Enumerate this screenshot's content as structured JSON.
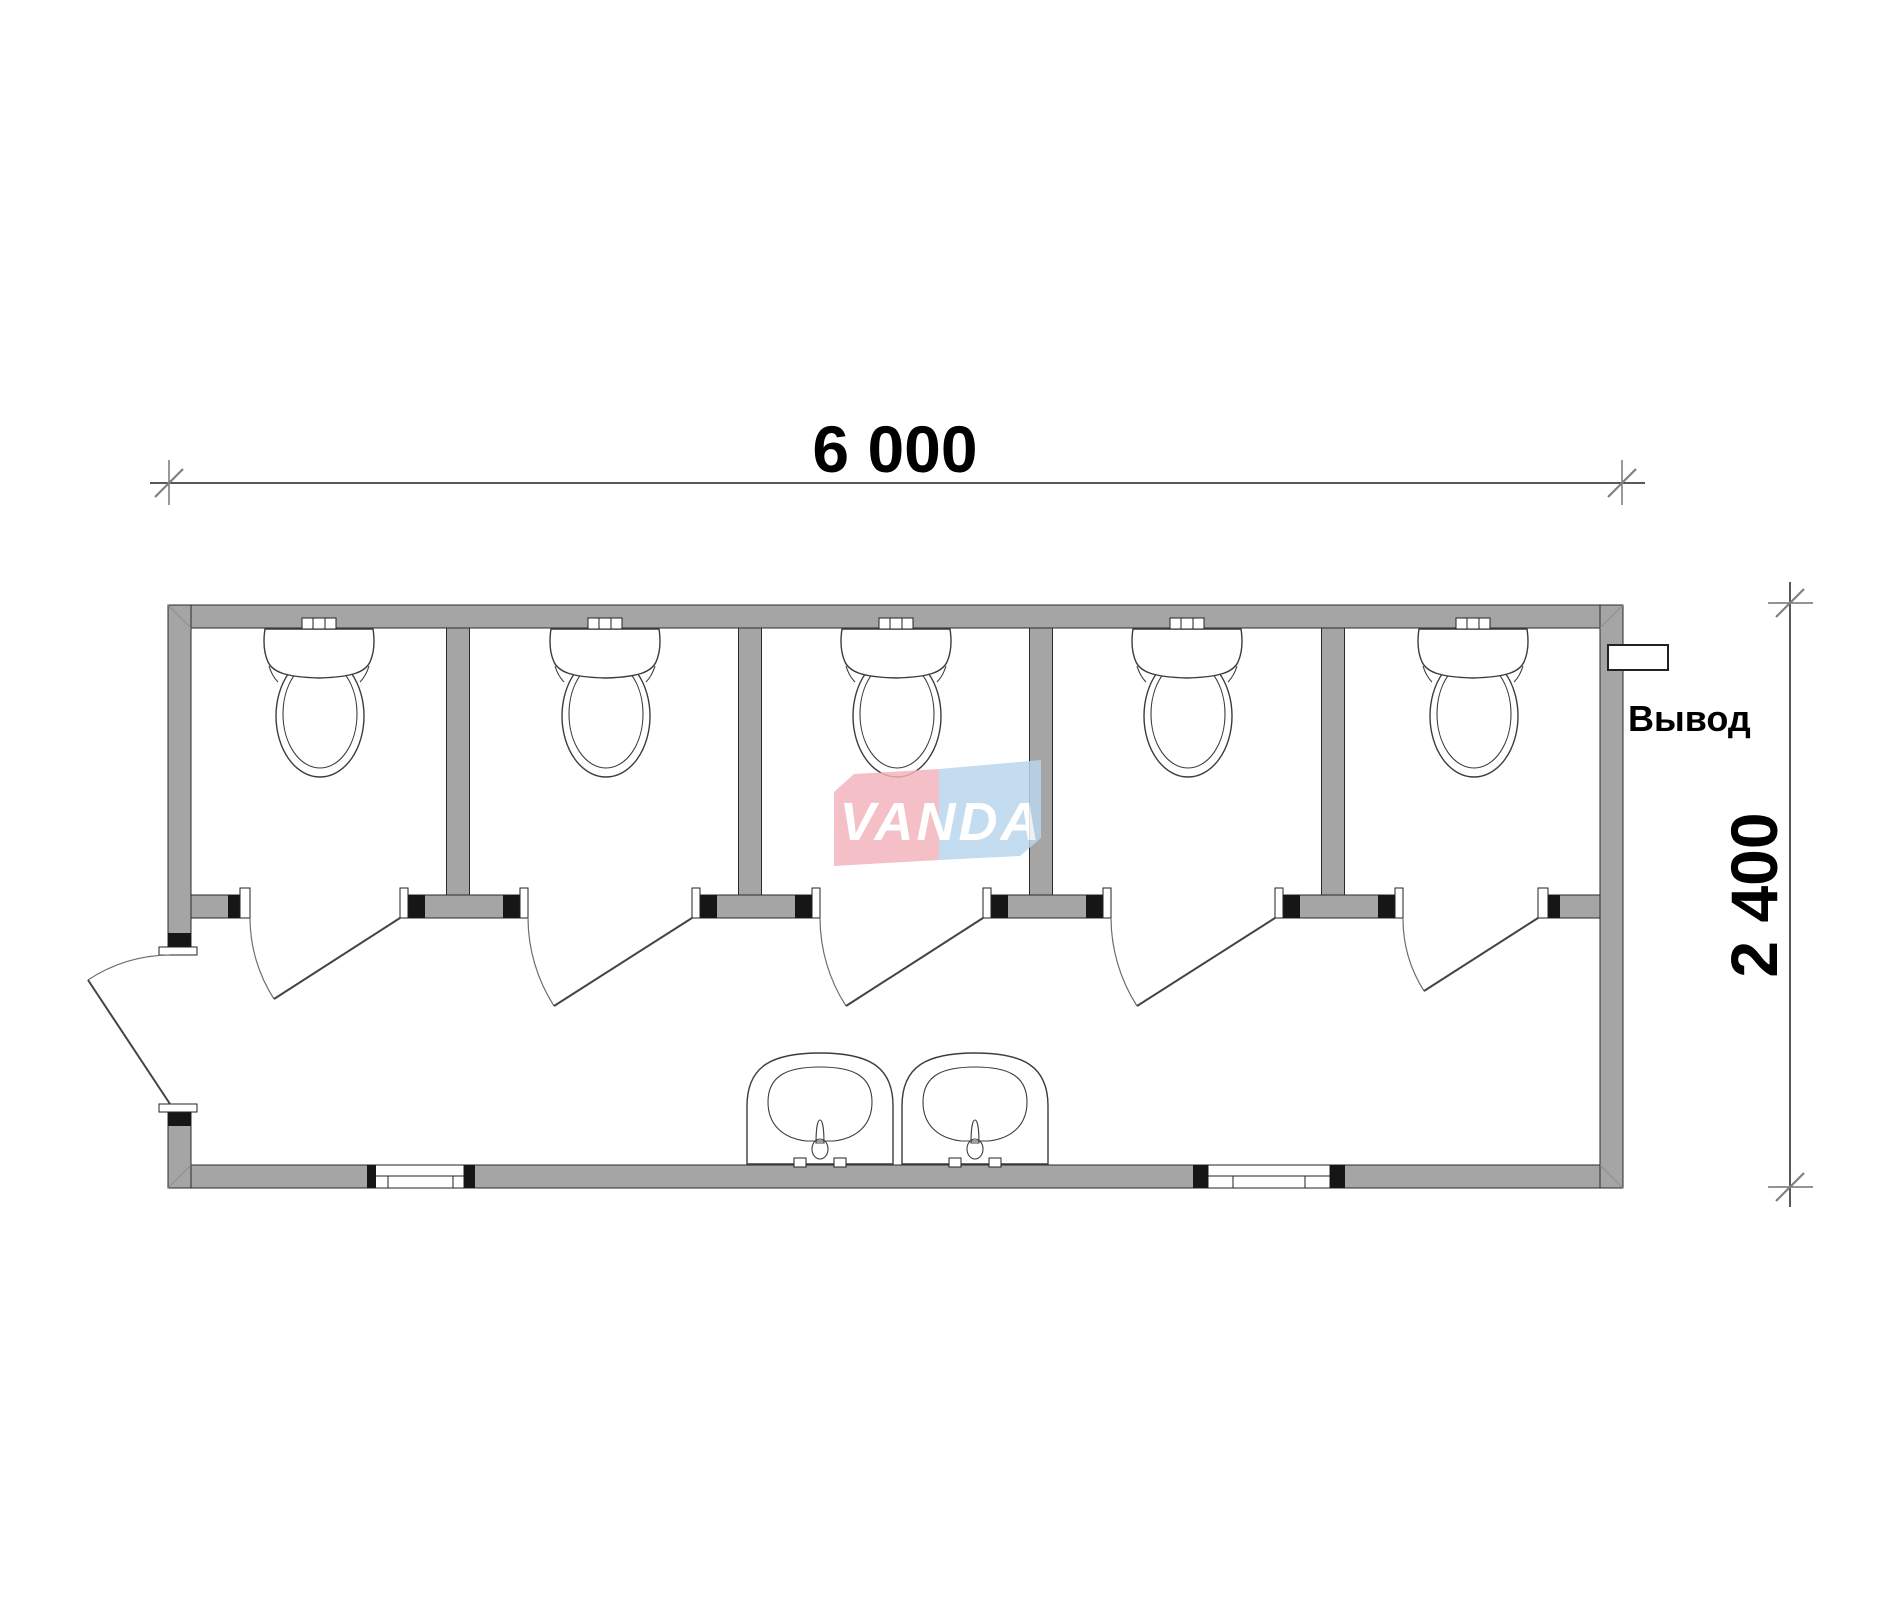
{
  "drawing": {
    "type": "floor-plan",
    "subject": "sanitary container module with 5 toilet stalls and 2 sinks",
    "dimensions": {
      "width_label": "6 000",
      "height_label": "2 400"
    },
    "labels": {
      "outlet": "Вывод"
    },
    "logo": {
      "text": "VANDA",
      "pink": "#f2b3bc",
      "blue": "#b9d6ee",
      "text_color": "#ffffff"
    },
    "counts": {
      "toilet_stalls": 5,
      "toilets": 5,
      "sinks": 2,
      "windows": 2,
      "stall_doors": 5,
      "entrance_doors": 1
    },
    "colors": {
      "wall": "#a5a5a5",
      "outline": "#222222",
      "door_arc": "#6e6e6e",
      "background": "#ffffff",
      "text": "#000000"
    }
  }
}
